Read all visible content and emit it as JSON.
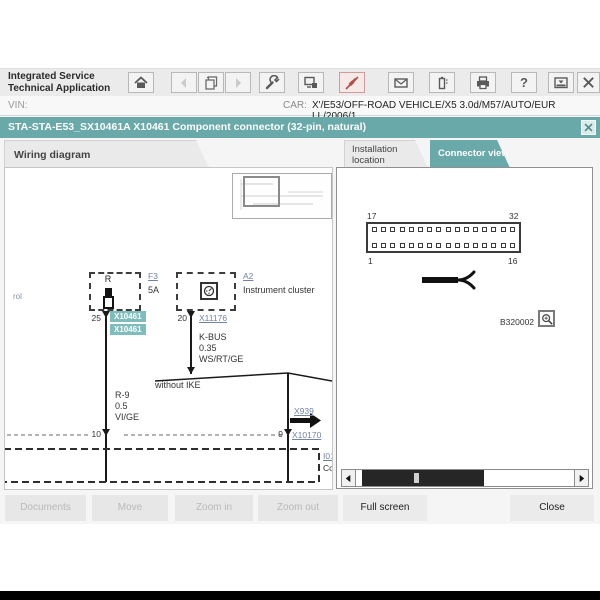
{
  "header": {
    "app_title_line1": "Integrated Service",
    "app_title_line2": "Technical Application",
    "vin_label": "VIN:",
    "car_label": "CAR:",
    "car_value": "X'/E53/OFF-ROAD VEHICLE/X5 3.0d/M57/AUTO/EUR LL/2006/1"
  },
  "toolbar": {
    "help_glyph": "?",
    "icons": [
      "home",
      "back",
      "copy-pages",
      "forward",
      "wrench",
      "workshop-system",
      "connection-active",
      "mail",
      "battery",
      "print",
      "help",
      "minimize-tray",
      "close"
    ]
  },
  "titlebar": {
    "title": "STA-STA-E53_SX10461A X10461 Component connector (32-pin, natural)"
  },
  "tabs": {
    "wiring": "Wiring diagram",
    "installation": "Installation location",
    "connector": "Connector view"
  },
  "wiring": {
    "edge_text": "rol",
    "fuse_box_label": "R",
    "fuse_ref": "F3",
    "fuse_rating": "5A",
    "fuse_pin": "25",
    "fuse_connector_a": "X10461",
    "fuse_connector_b": "X10461",
    "cluster_ref": "A2",
    "cluster_name": "Instrument cluster",
    "cluster_pin": "20",
    "cluster_connector": "X11176",
    "wire_bus": "K-BUS",
    "wire_gauge": "0.35",
    "wire_color": "WS/RT/GE",
    "branch_note": "without IKE",
    "left_wire_name": "R-9",
    "left_wire_gauge": "0.5",
    "left_wire_color": "VI/GE",
    "left_pin": "10",
    "bridge_ref": "X939",
    "right_pin": "9",
    "right_connector": "X10170",
    "module_ref": "I01",
    "module_name": "Co"
  },
  "connector_view": {
    "pin_top_left": "17",
    "pin_top_right": "32",
    "pin_bottom_left": "1",
    "pin_bottom_right": "16",
    "figure_id": "B320002"
  },
  "buttons": {
    "documents": "Documents",
    "move": "Move",
    "zoom_in": "Zoom in",
    "zoom_out": "Zoom out",
    "full_screen": "Full screen",
    "close": "Close"
  },
  "colors": {
    "teal": "#69a9a9",
    "teal_tag": "#7fbcbc",
    "link_blue": "#7282a8",
    "active_icon_red": "#b14f48"
  }
}
